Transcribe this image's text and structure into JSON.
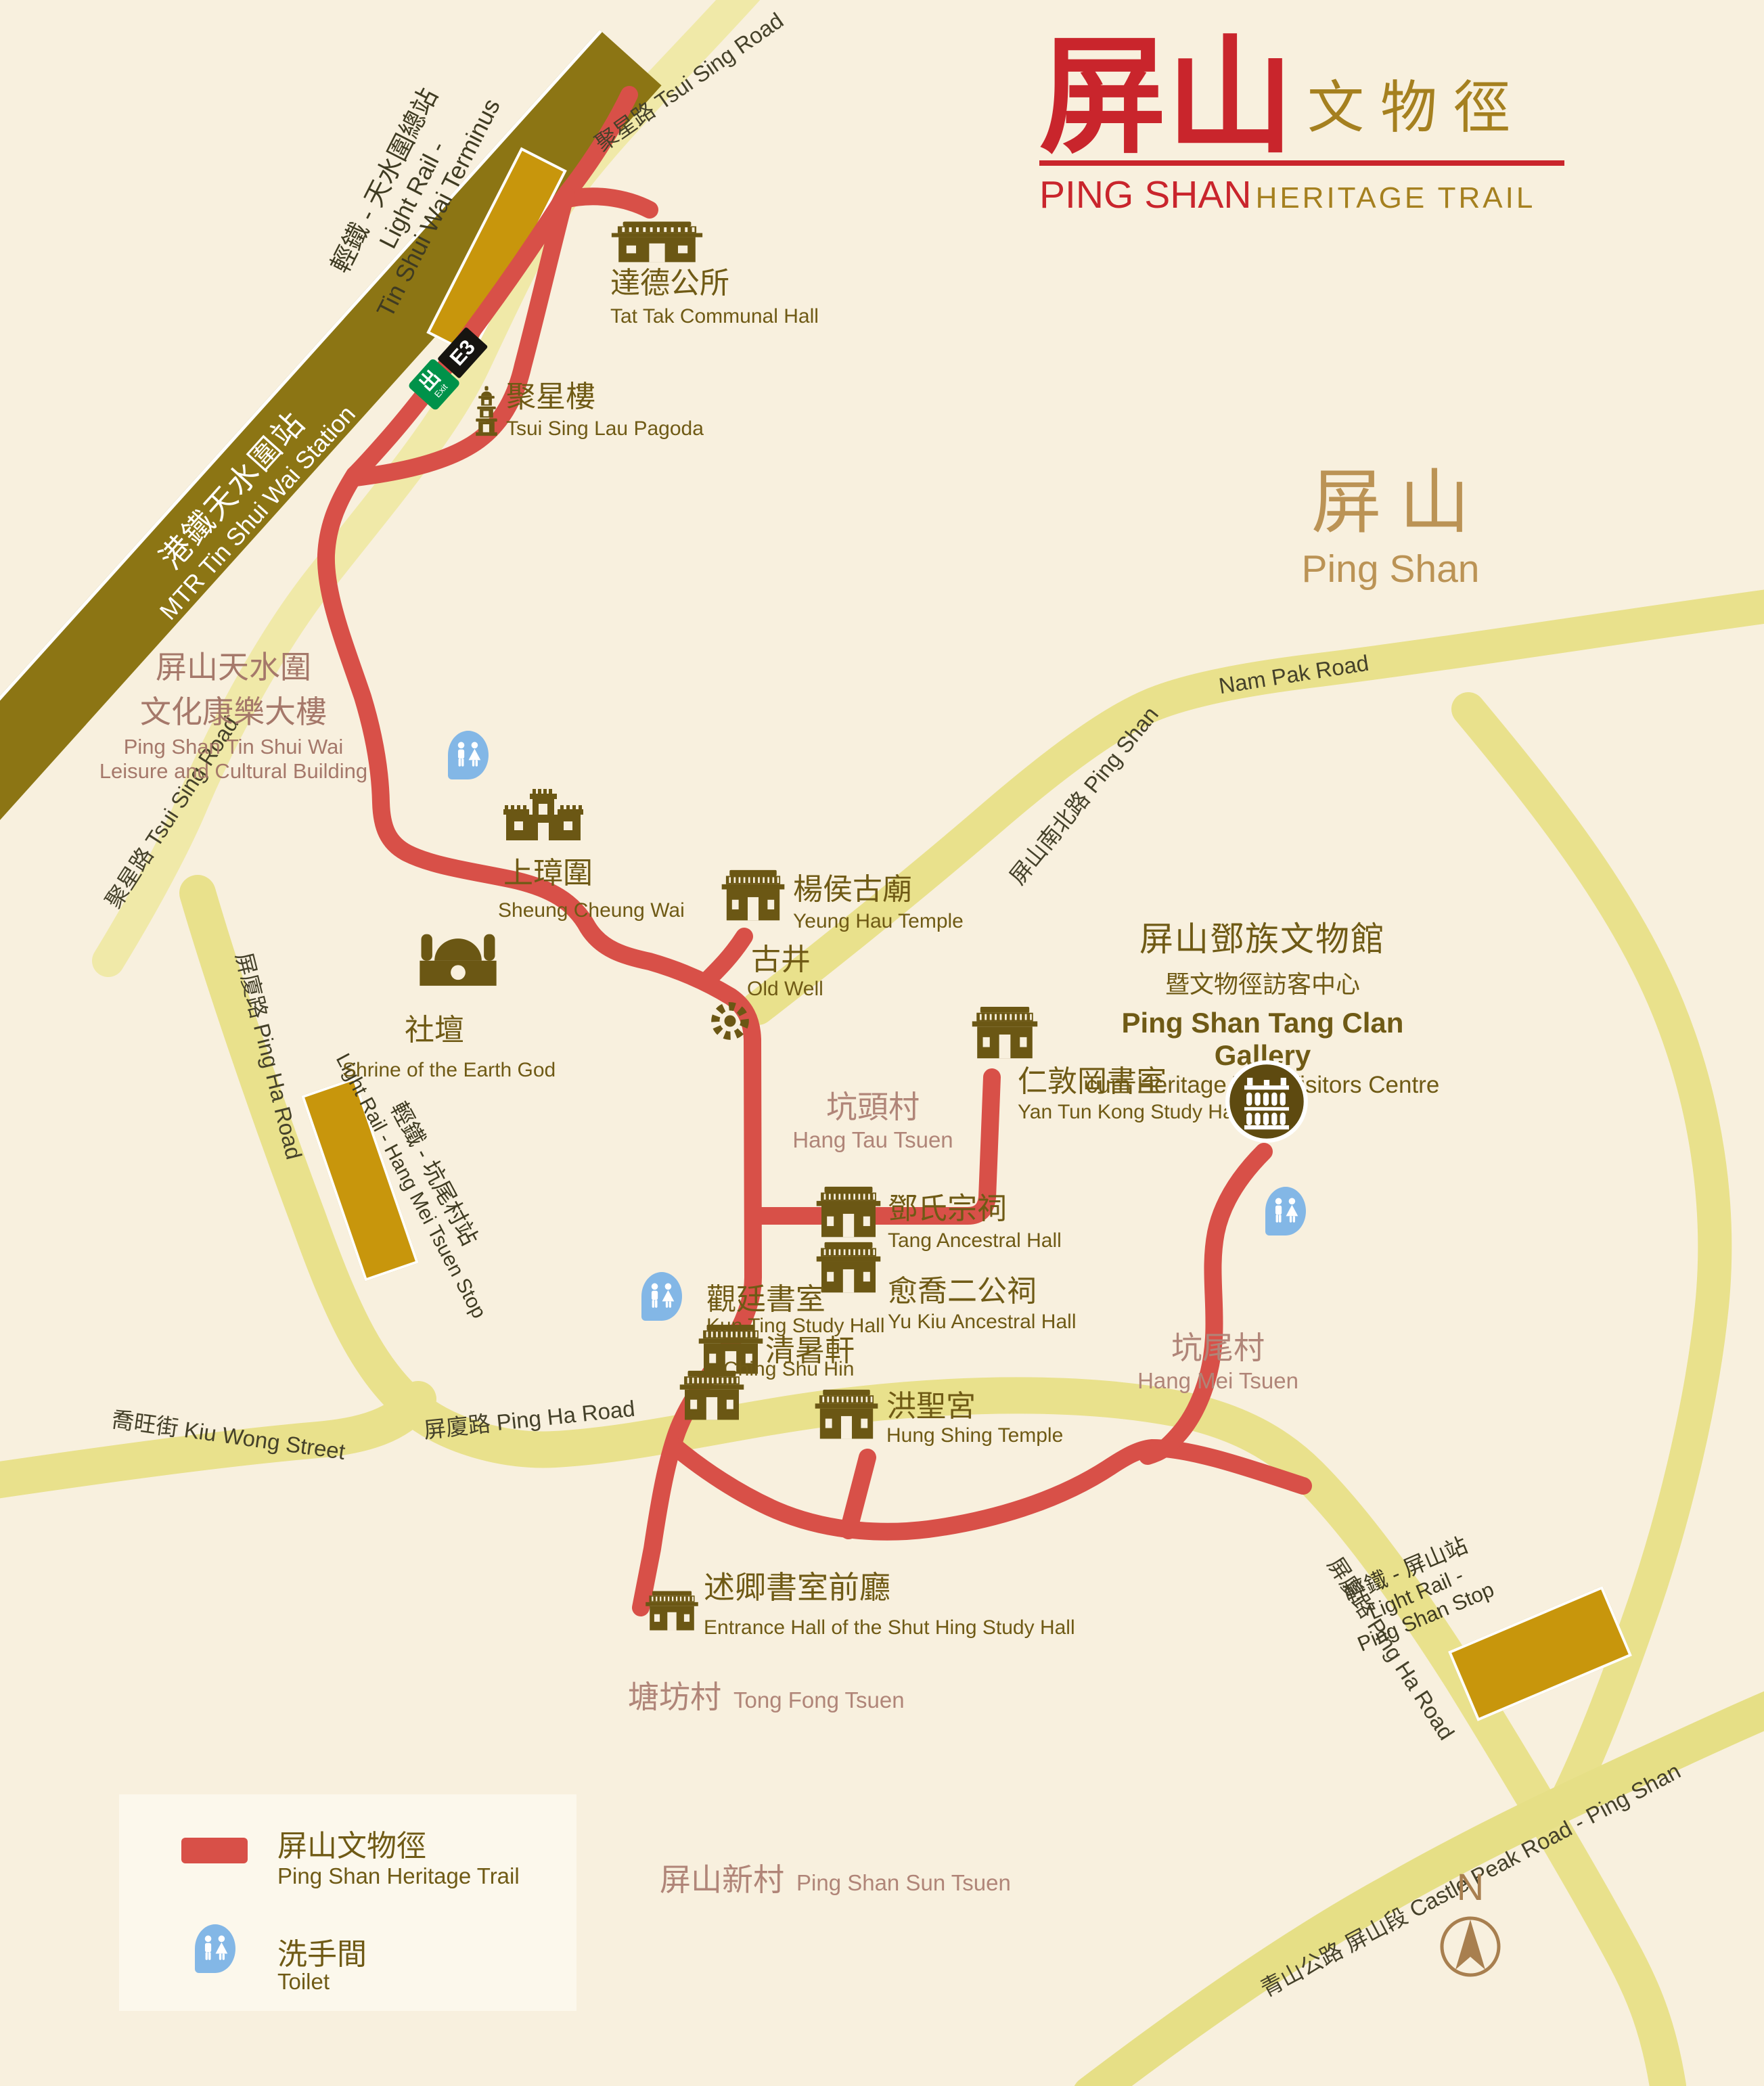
{
  "title": {
    "zh_main": "屏山",
    "zh_sub": "文物徑",
    "en_main": "PING SHAN",
    "en_sub": "HERITAGE TRAIL"
  },
  "region": {
    "zh": "屏  山",
    "en": "Ping Shan"
  },
  "stations": {
    "mtr_zh": "港鐵天水圍站",
    "mtr_en": "MTR Tin Shui Wai Station",
    "lr_terminus_zh": "輕鐵 - 天水圍總站",
    "lr_terminus_en1": "Light Rail -",
    "lr_terminus_en2": "Tin Shui Wai Terminus",
    "exit_zh": "出",
    "exit_en": "Exit",
    "exit_code": "E3",
    "lr_hang_mei_zh": "輕鐵 - 坑尾村站",
    "lr_hang_mei_en": "Light Rail - Hang Mei Tsuen Stop",
    "lr_ping_shan_zh": "輕鐵 - 屏山站",
    "lr_ping_shan_en1": "Light Rail -",
    "lr_ping_shan_en2": "Ping Shan Stop"
  },
  "roads": {
    "tsui_sing_top": "聚星路 Tsui Sing Road",
    "tsui_sing_left": "聚星路 Tsui Sing Road",
    "ping_ha_left": "屏廈路 Ping Ha Road",
    "ping_ha_mid": "屏廈路 Ping Ha Road",
    "ping_ha_se": "屏廈路 Ping Ha Road",
    "nam_pak_upper": "屏山南北路 Ping Shan",
    "nam_pak_lower": "Nam Pak Road",
    "kiu_wong": "喬旺街 Kiu Wong Street",
    "castle_peak": "青山公路 屏山段 Castle Peak Road - Ping Shan"
  },
  "landmarks": [
    {
      "id": "tat_tak",
      "zh": "達德公所",
      "en": "Tat Tak Communal Hall"
    },
    {
      "id": "pagoda",
      "zh": "聚星樓",
      "en": "Tsui Sing Lau Pagoda"
    },
    {
      "id": "sheung_cheung",
      "zh": "上璋圍",
      "en": "Sheung Cheung Wai"
    },
    {
      "id": "yeung_hau",
      "zh": "楊侯古廟",
      "en": "Yeung Hau Temple"
    },
    {
      "id": "old_well",
      "zh": "古井",
      "en": "Old Well"
    },
    {
      "id": "shrine",
      "zh": "社壇",
      "en": "Shrine of the Earth God"
    },
    {
      "id": "yan_tun_kong",
      "zh": "仁敦岡書室",
      "en": "Yan Tun Kong Study Hall"
    },
    {
      "id": "tang_hall",
      "zh": "鄧氏宗祠",
      "en": "Tang Ancestral Hall"
    },
    {
      "id": "yu_kiu",
      "zh": "愈喬二公祠",
      "en": "Yu Kiu Ancestral Hall"
    },
    {
      "id": "kun_ting",
      "zh": "觀廷書室",
      "en": "Kun Ting Study Hall"
    },
    {
      "id": "ching_shu_hin",
      "zh": "清暑軒",
      "en": "Ching Shu Hin"
    },
    {
      "id": "hung_shing",
      "zh": "洪聖宮",
      "en": "Hung Shing Temple"
    },
    {
      "id": "shut_hing",
      "zh": "述卿書室前廳",
      "en": "Entrance Hall of the Shut Hing Study Hall"
    }
  ],
  "gallery": {
    "zh1": "屏山鄧族文物館",
    "zh2": "暨文物徑訪客中心",
    "en1": "Ping Shan Tang Clan Gallery",
    "en2": "cum Heritage Trail Visitors Centre"
  },
  "villages": [
    {
      "id": "hang_tau",
      "zh": "坑頭村",
      "en": "Hang Tau Tsuen"
    },
    {
      "id": "hang_mei",
      "zh": "坑尾村",
      "en": "Hang Mei Tsuen"
    },
    {
      "id": "tong_fong",
      "zh": "塘坊村",
      "en": "Tong Fong Tsuen"
    },
    {
      "id": "sun_tsuen",
      "zh": "屏山新村",
      "en": "Ping Shan Sun Tsuen"
    }
  ],
  "building": {
    "zh1": "屏山天水圍",
    "zh2": "文化康樂大樓",
    "en1": "Ping Shan Tin Shui Wai",
    "en2": "Leisure and Cultural Building"
  },
  "legend": {
    "trail_zh": "屏山文物徑",
    "trail_en": "Ping Shan Heritage Trail",
    "toilet_zh": "洗手間",
    "toilet_en": "Toilet"
  },
  "compass_label": "N",
  "colors": {
    "trail": "#d85048",
    "road": "#e9e18c",
    "road_pale": "#f0e9a8",
    "mtr_band": "#8c7514",
    "light_rail_stop": "#c8960c",
    "landmark_brown": "#6f5a15",
    "village_rose": "#b08578",
    "title_red": "#c9252c",
    "title_brown": "#a5801f",
    "toilet_blue": "#83b7e6",
    "exit_green": "#00924a"
  }
}
